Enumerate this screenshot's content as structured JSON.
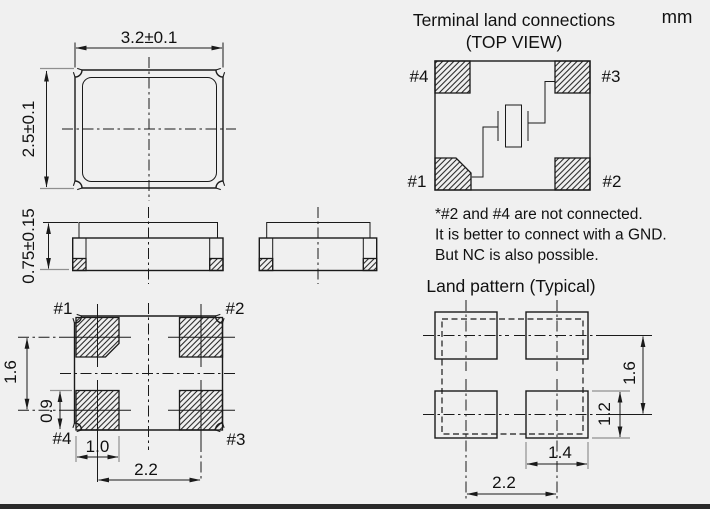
{
  "unit_label": "mm",
  "colors": {
    "background": "#f0f0f0",
    "line": "#1a1a1a",
    "extension_line": "#8f8f8f",
    "text": "#111111",
    "bottom_border": "#2a2a2a"
  },
  "top_view": {
    "width_dim": "3.2±0.1",
    "height_dim": "2.5±0.1"
  },
  "side_view": {
    "height_dim": "0.75±0.15"
  },
  "bottom_view": {
    "labels": {
      "p1": "#1",
      "p2": "#2",
      "p3": "#3",
      "p4": "#4"
    },
    "dims": {
      "row_pitch": "1.6",
      "pad_height": "0.9",
      "pad_width": "1.0",
      "col_pitch": "2.2"
    }
  },
  "terminal_connections": {
    "title": "Terminal land connections",
    "subtitle": "(TOP VIEW)",
    "labels": {
      "p1": "#1",
      "p2": "#2",
      "p3": "#3",
      "p4": "#4"
    },
    "notes": [
      "*#2 and #4 are not connected.",
      "It is better to connect with a GND.",
      "But NC is also possible."
    ]
  },
  "land_pattern": {
    "title": "Land pattern (Typical)",
    "dims": {
      "row_pitch": "1.6",
      "pad_height": "1.2",
      "pad_width": "1.4",
      "col_pitch": "2.2"
    }
  }
}
